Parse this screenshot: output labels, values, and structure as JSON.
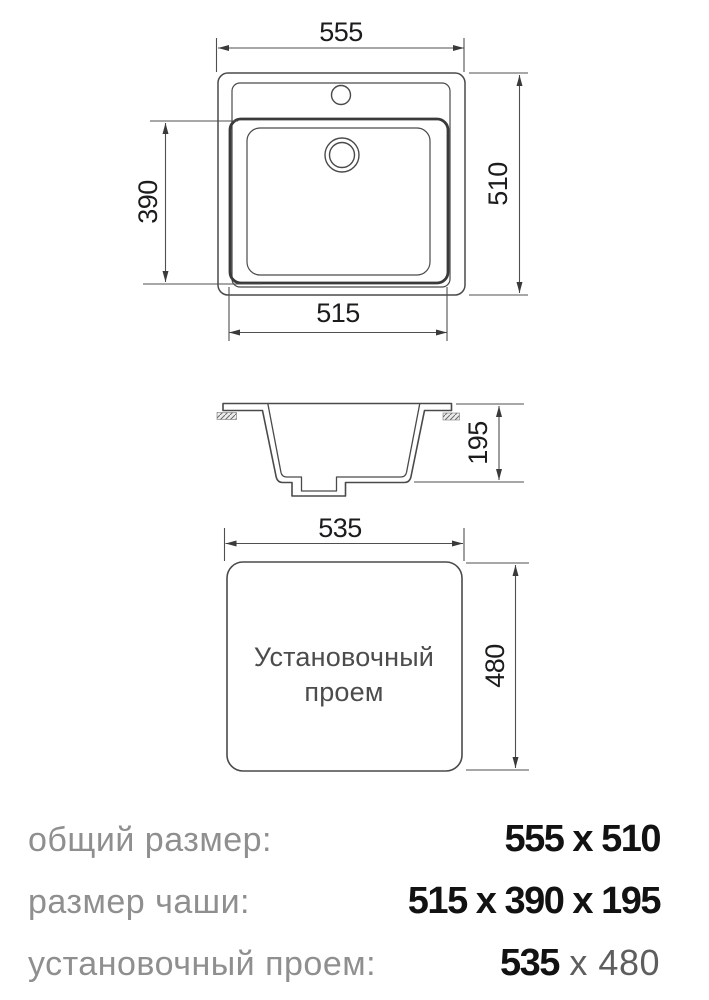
{
  "diagram": {
    "top_view": {
      "dim_overall_width": "555",
      "dim_overall_depth": "510",
      "dim_bowl_depth": "390",
      "dim_bowl_width": "515"
    },
    "side_view": {
      "dim_bowl_height": "195"
    },
    "opening_view": {
      "dim_width": "535",
      "dim_height": "480",
      "label_line1": "Установочный",
      "label_line2": "проем"
    },
    "colors": {
      "line": "#4a4a4a",
      "bowl_edge": "#3a3a3a",
      "dim_text": "#1c1c1e",
      "label_gray": "#8f8f8f",
      "value_black": "#121212"
    }
  },
  "specs": {
    "rows": [
      {
        "label": "общий размер:",
        "value": "555 x 510",
        "value2": ""
      },
      {
        "label": "размер чаши:",
        "value": "515 x 390 x 195",
        "value2": ""
      },
      {
        "label": "установочный проем:",
        "value": "535",
        "value2": " x 480"
      }
    ]
  }
}
